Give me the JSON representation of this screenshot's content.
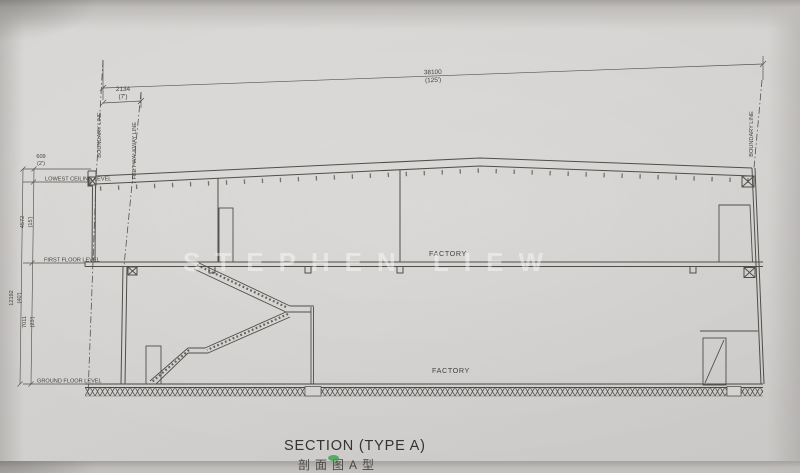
{
  "title": {
    "text": "SECTION (TYPE A)",
    "caption_partial": "剖面图A型"
  },
  "watermark": {
    "text": "STEPHEN LIEW"
  },
  "labels": {
    "factory_upper": "FACTORY",
    "factory_lower": "FACTORY",
    "lowest_ceiling_level": "LOWEST CEILING LEVEL",
    "first_floor_level": "FIRST FLOOR LEVEL",
    "ground_floor_level": "GROUND FLOOR LEVEL",
    "boundary_left": "BOUNDARY LINE",
    "boundary_right": "BOUNDARY LINE",
    "walkway_line": "7 FEET WALKWAY LINE"
  },
  "dimensions": {
    "total_width": {
      "mm": "38100",
      "ft": "(125')"
    },
    "walkway": {
      "mm": "2134",
      "ft": "(7')"
    },
    "parapet": {
      "mm": "609",
      "ft": "(2')"
    },
    "ceiling_to_first": {
      "mm": "4572",
      "ft": "(15')"
    },
    "first_to_ground": {
      "mm": "7011",
      "ft": "(23')"
    },
    "total_height": {
      "mm": "12192",
      "ft": "(40')"
    }
  },
  "colors": {
    "paper": "#d3d1cf",
    "ink": "#504e49",
    "highlight_green": "#3fa352"
  }
}
